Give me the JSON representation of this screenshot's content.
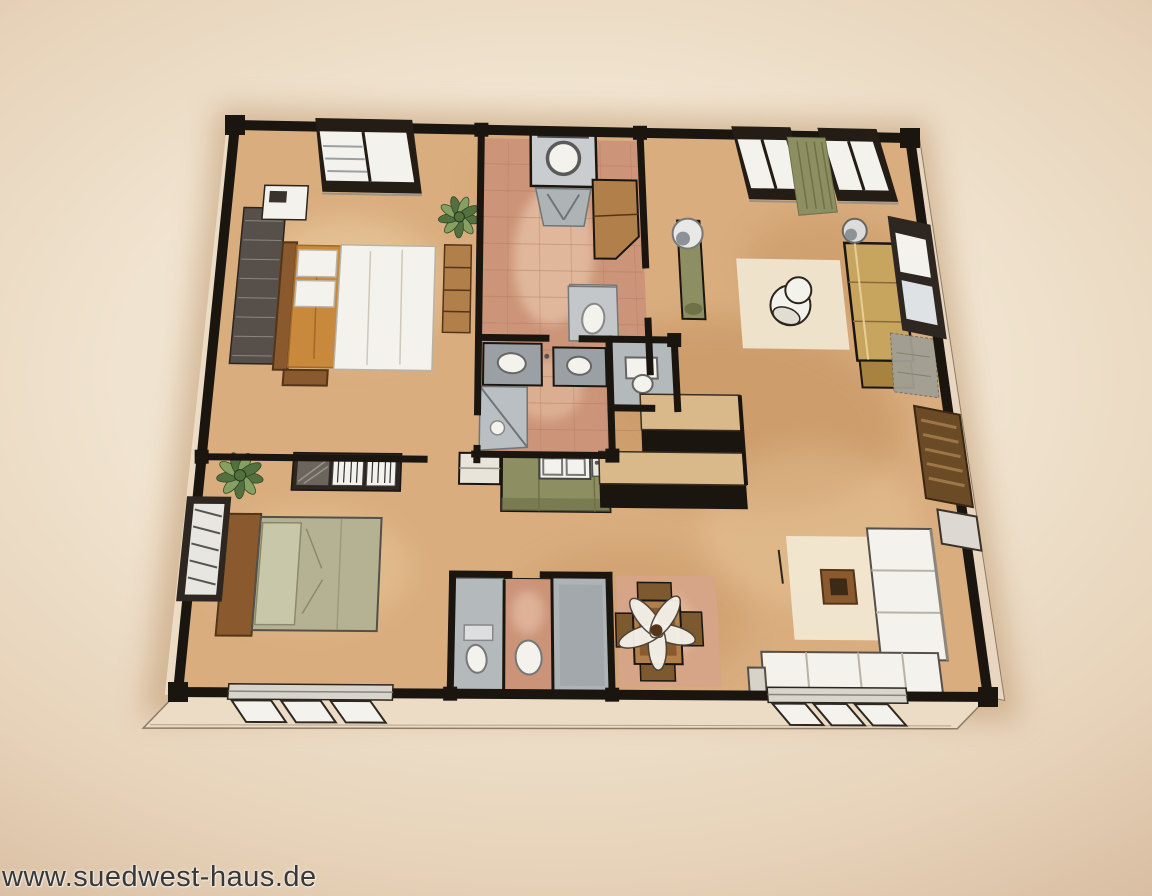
{
  "watermark": {
    "text": "www.suedwest-haus.de"
  },
  "scene": {
    "description": "Hand-drawn watercolor 3D floor plan of an apartment seen from above at an angle",
    "rooms": [
      {
        "name": "bedroom-top-left",
        "items": [
          "double-bed",
          "orange-blanket",
          "white-duvet",
          "pillows",
          "headboard-bench",
          "foot-bench",
          "nightstand",
          "dark-rug",
          "potted-plant",
          "tall-shelf",
          "top-wall-window"
        ]
      },
      {
        "name": "entry-hall",
        "items": [
          "washing-machine",
          "laundry-chair",
          "entry-cabinet",
          "toilet",
          "terracotta-tiles"
        ]
      },
      {
        "name": "bathroom-center",
        "items": [
          "twin-sink-vanity",
          "corner-shower",
          "terracotta-tiles"
        ]
      },
      {
        "name": "wc",
        "items": [
          "toilet"
        ]
      },
      {
        "name": "kitchen",
        "items": [
          "kitchen-counter",
          "kitchen-sink",
          "cooktop",
          "side-cabinet",
          "bar-counter-upper",
          "bar-counter-lower"
        ]
      },
      {
        "name": "living-room",
        "items": [
          "coat-stand-lamp",
          "white-rug",
          "armchair",
          "khaki-sofa",
          "floor-lamp",
          "wall-window",
          "gray-rug",
          "sectional-sofa",
          "coffee-table",
          "area-rug",
          "shuttered-window",
          "picture-frame",
          "curtain",
          "top-wall-windows",
          "bottom-wall-window"
        ]
      },
      {
        "name": "dining-area",
        "items": [
          "dining-table",
          "dining-chairs",
          "flower-centerpiece",
          "area-rug"
        ]
      },
      {
        "name": "bedroom-bottom-left",
        "items": [
          "double-bed",
          "sage-duvet",
          "headboard",
          "potted-plant",
          "book-shelf",
          "left-wall-window",
          "bottom-wall-window"
        ]
      },
      {
        "name": "bathroom-bottom",
        "items": [
          "shower-left",
          "toilet",
          "bidet",
          "shower-right",
          "terracotta-tiles"
        ]
      }
    ]
  },
  "palette": {
    "wall": "#1b1510",
    "outline": "#2c251c",
    "floor": "#d9ad7e",
    "floor_shade": "#c08c58",
    "floor_light": "#eed2a6",
    "tile": "#cb9378",
    "tile_light": "#e6c0a4",
    "tile_line": "#b07a5f",
    "gray_fixture": "#b7bcbe",
    "gray_mid": "#9aa0a4",
    "gray_dark": "#6f7578",
    "white": "#f4f2ec",
    "cream_rug": "#f1e7d2",
    "sage": "#b4b293",
    "sage_light": "#c9c7a9",
    "olive": "#8d8f62",
    "olive_dark": "#6f7147",
    "khaki": "#c8a55f",
    "khaki_dark": "#8a6a3a",
    "orange": "#c8893c",
    "wood": "#8a5a2e",
    "wood_dark": "#543518",
    "wood_light": "#b07f4a",
    "plant_dark": "#55703f",
    "plant_light": "#87a061",
    "skirt": "#ecdcc5",
    "skirt_line": "#8d7c66",
    "pink_rug": "#d6a488",
    "gray_rug": "#a19f94",
    "counter_top": "#d9b98a",
    "shadow": "#b98f63"
  }
}
